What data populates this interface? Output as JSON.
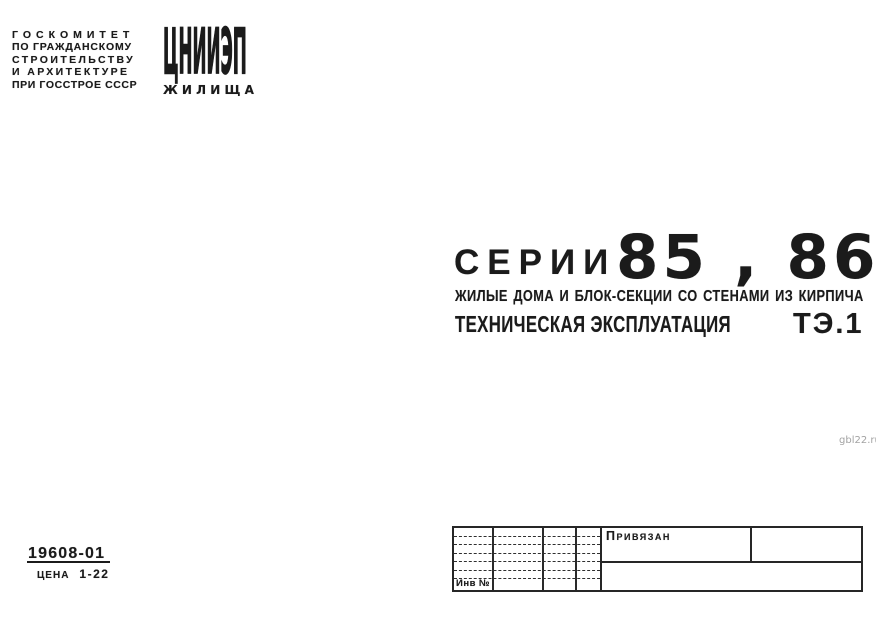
{
  "colors": {
    "ink": "#1b1b1b",
    "paper": "#ffffff",
    "watermark": "#a3a3a3"
  },
  "publisher": {
    "lines": [
      "ГОСКОМИТЕТ",
      "ПО ГРАЖДАНСКОМУ",
      "СТРОИТЕЛЬСТВУ",
      "И АРХИТЕКТУРЕ",
      "ПРИ ГОССТРОЕ СССР"
    ]
  },
  "logo": {
    "acronym": "ЦНИИЭП",
    "word": "ЖИЛИЩА"
  },
  "title": {
    "series_label": "СЕРИИ",
    "series_numbers": "85 , 86",
    "subtitle": "ЖИЛЫЕ ДОМА И БЛОК-СЕКЦИИ СО СТЕНАМИ ИЗ КИРПИЧА",
    "doc_type": "ТЕХНИЧЕСКАЯ ЭКСПЛУАТАЦИЯ",
    "doc_code": "ТЭ.1"
  },
  "imprint": {
    "order_number": "19608-01",
    "price_label": "ЦЕНА",
    "price_value": "1-22"
  },
  "stamp": {
    "note": "Привязан",
    "inventory_label": "Инв №"
  },
  "watermark": {
    "text": "gbl22.ru"
  }
}
